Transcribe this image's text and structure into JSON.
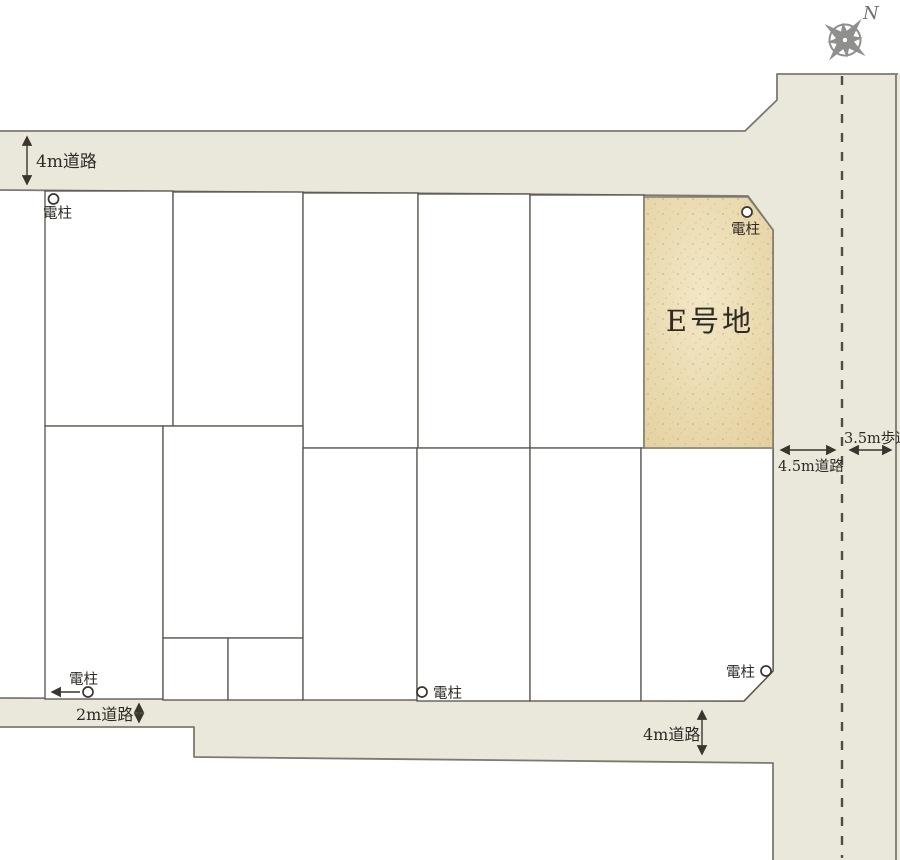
{
  "plan": {
    "compass_north": "N",
    "featured_lot_label": "E号地",
    "pole_label": "電柱",
    "roads": {
      "top_label": "4m道路",
      "bottom_left_label": "2m道路",
      "bottom_right_label": "4m道路",
      "right_label": "4.5m道路",
      "sidewalk_label": "3.5m歩道"
    },
    "colors": {
      "road_surface": "#e9e8db",
      "road_edge": "#7d7970",
      "lot_line": "#56514b",
      "lot_fill": "#ffffff",
      "featured_fill": "#e4d09e",
      "featured_highlight": "#f2e7c6",
      "featured_speckle": "#c4a261",
      "text": "#2e2a26",
      "compass": "#8f8f8d",
      "centerline": "#4f4d48"
    }
  }
}
